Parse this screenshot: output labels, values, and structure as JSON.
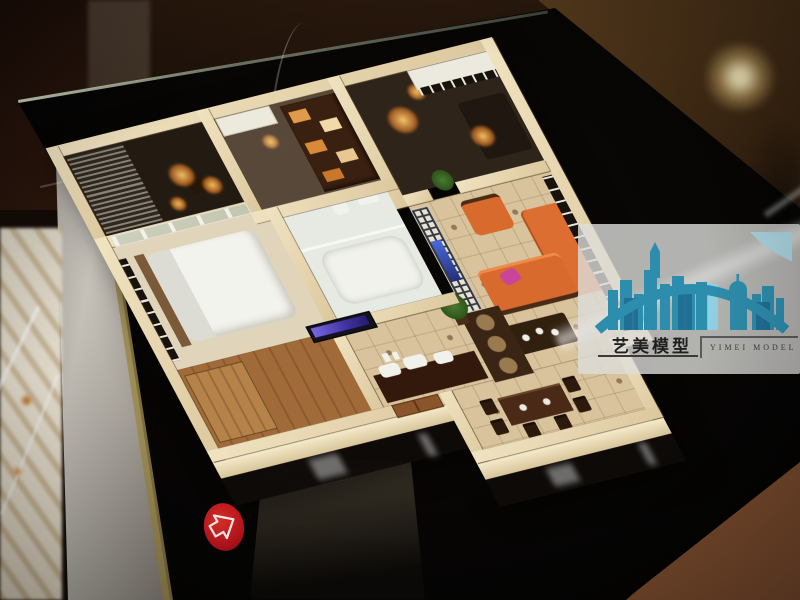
{
  "scene": {
    "subject": "architectural interior scale model of an apartment, displayed on a glossy black table",
    "palette": {
      "model_walls": "#e9dab6",
      "table_black": "#060504",
      "table_rim_silver": "#c6c2ba",
      "bronze_floor": "#54391c",
      "terracotta_floor": "#8a5636",
      "sofa_orange": "#d96a2e",
      "sticker_red": "#c01622",
      "logo_teal": "#2d8dac"
    }
  },
  "watermark": {
    "brand_cn": "艺美模型",
    "brand_en": "YIMEI MODEL"
  },
  "sticker": {
    "shape": "red oval with white outlined arrow",
    "direction": "right"
  }
}
